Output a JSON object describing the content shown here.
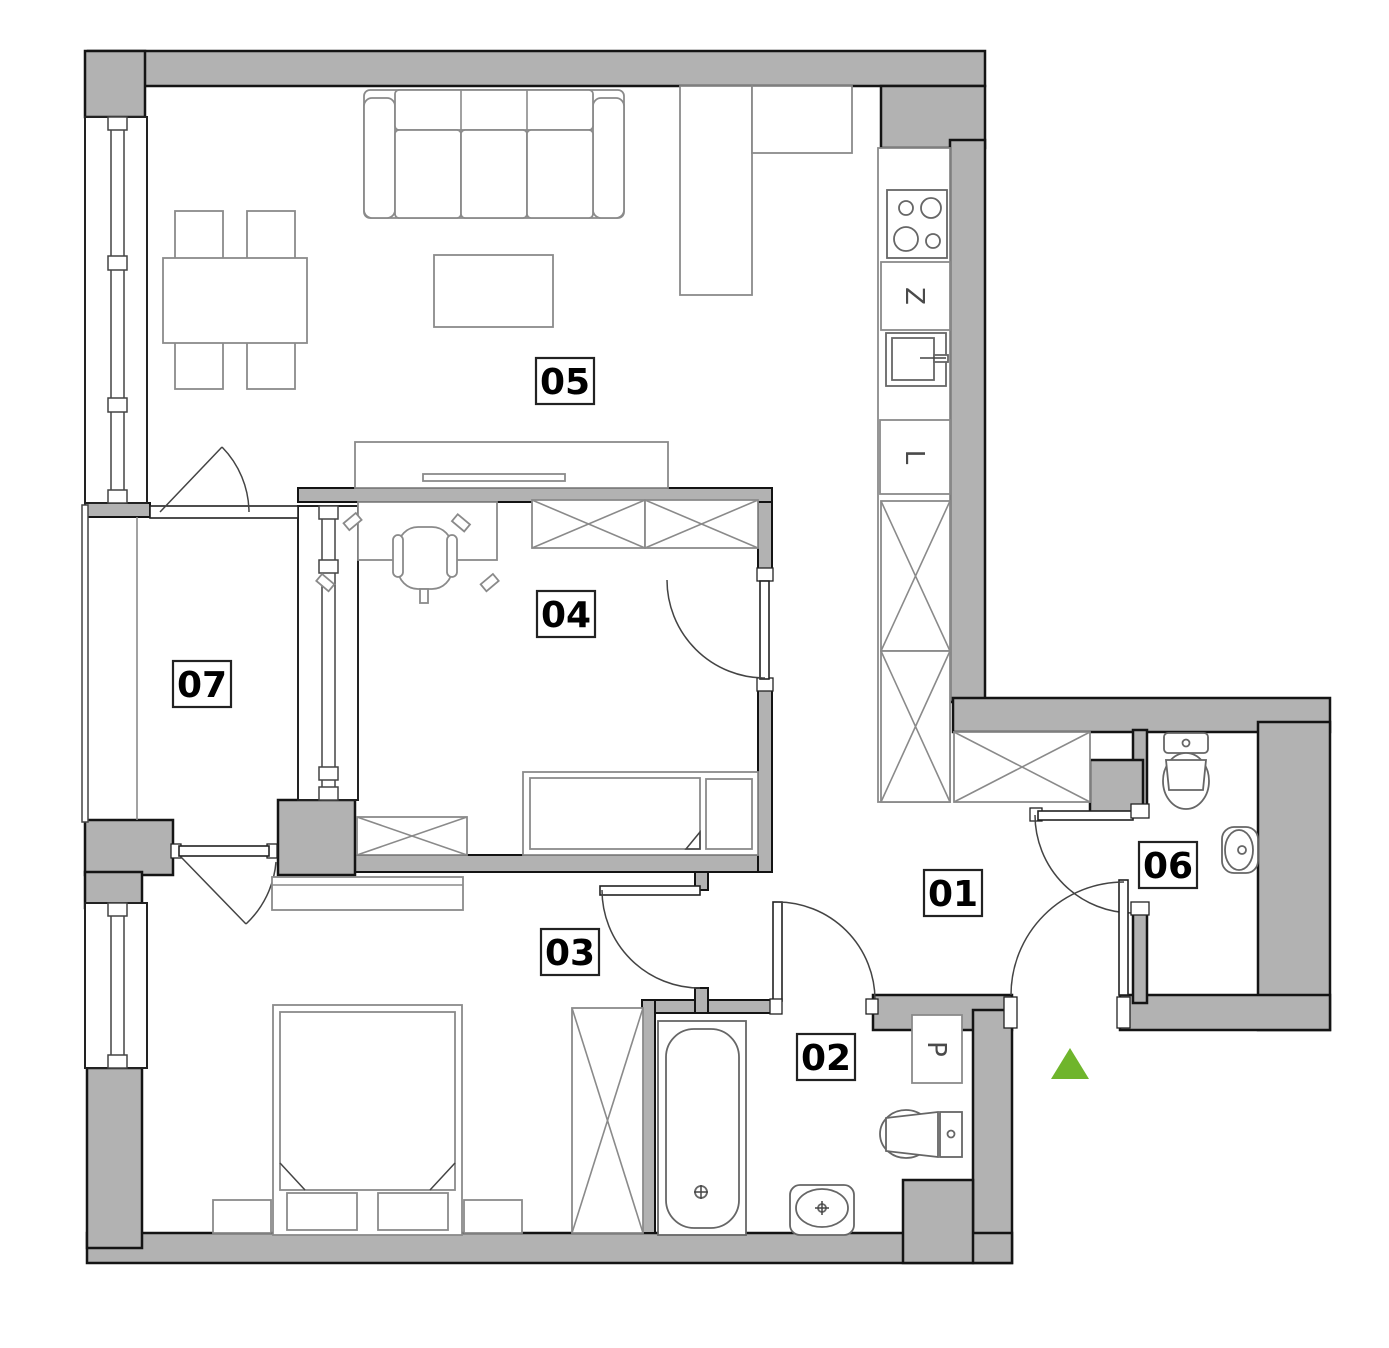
{
  "rooms": [
    {
      "label": "01"
    },
    {
      "label": "02"
    },
    {
      "label": "03"
    },
    {
      "label": "04"
    },
    {
      "label": "05"
    },
    {
      "label": "06"
    },
    {
      "label": "07"
    }
  ],
  "appliances": {
    "z": "Z",
    "l": "L",
    "p": "P"
  },
  "entrance": {
    "marker_color": "#6fb52c"
  },
  "colors": {
    "wall_fill": "#b2b2b2",
    "furniture_stroke": "#8a8a8a"
  }
}
